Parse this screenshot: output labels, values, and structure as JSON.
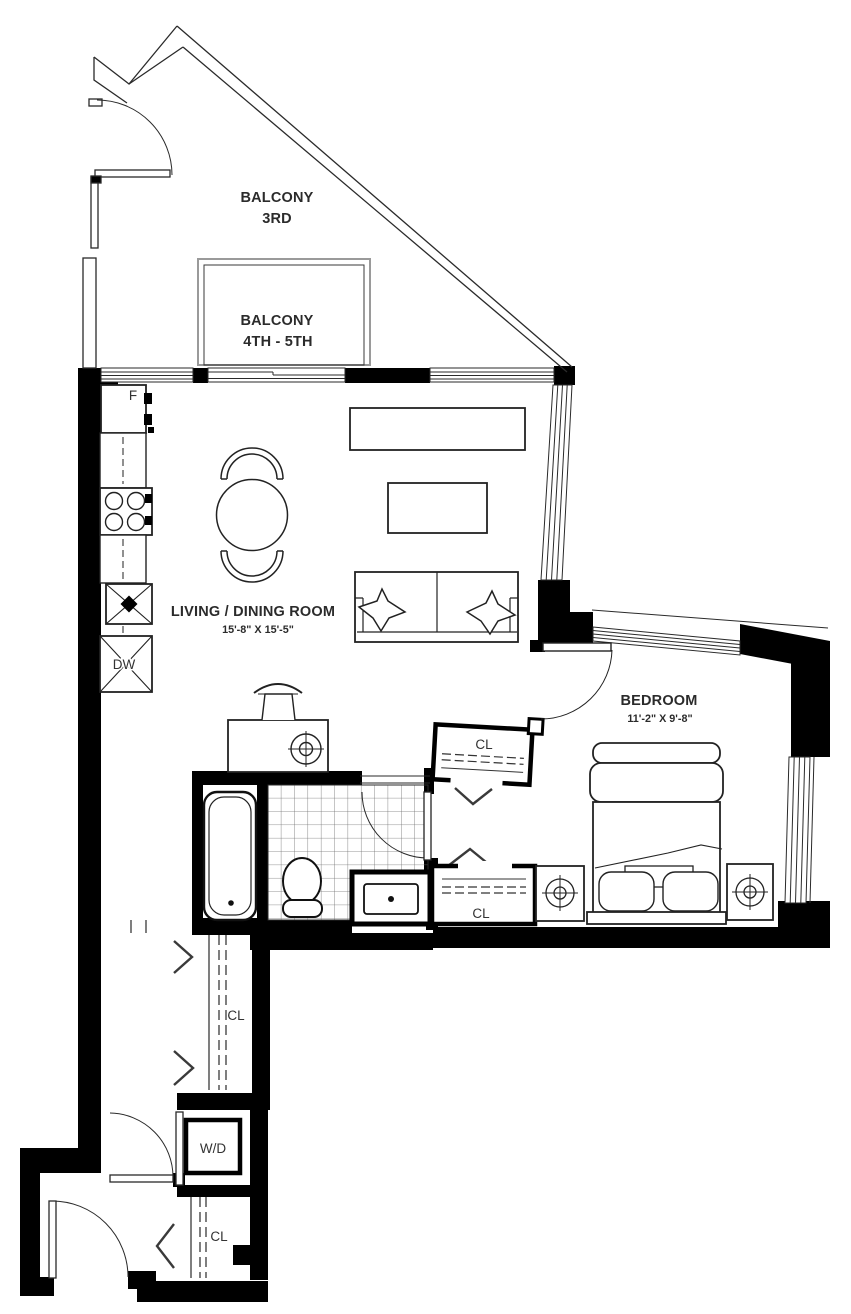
{
  "floorplan": {
    "rooms": {
      "balcony_3rd": {
        "label": "BALCONY",
        "sublabel": "3RD"
      },
      "balcony_4th_5th": {
        "label": "BALCONY",
        "sublabel": "4TH - 5TH"
      },
      "living_dining": {
        "label": "LIVING / DINING ROOM",
        "dimensions": "15'-8\" X 15'-5\""
      },
      "bedroom": {
        "label": "BEDROOM",
        "dimensions": "11'-2\" X 9'-8\""
      }
    },
    "fixtures": {
      "fridge": "F",
      "dishwasher": "DW",
      "washer_dryer": "W/D",
      "closet_bedroom_upper": "CL",
      "closet_bedroom_lower": "CL",
      "closet_hall": "CL",
      "closet_entry": "CL"
    },
    "colors": {
      "wall": "#000000",
      "line": "#2a2a2a",
      "background": "#ffffff",
      "window_frame_gray": "#9a9a9a"
    }
  }
}
